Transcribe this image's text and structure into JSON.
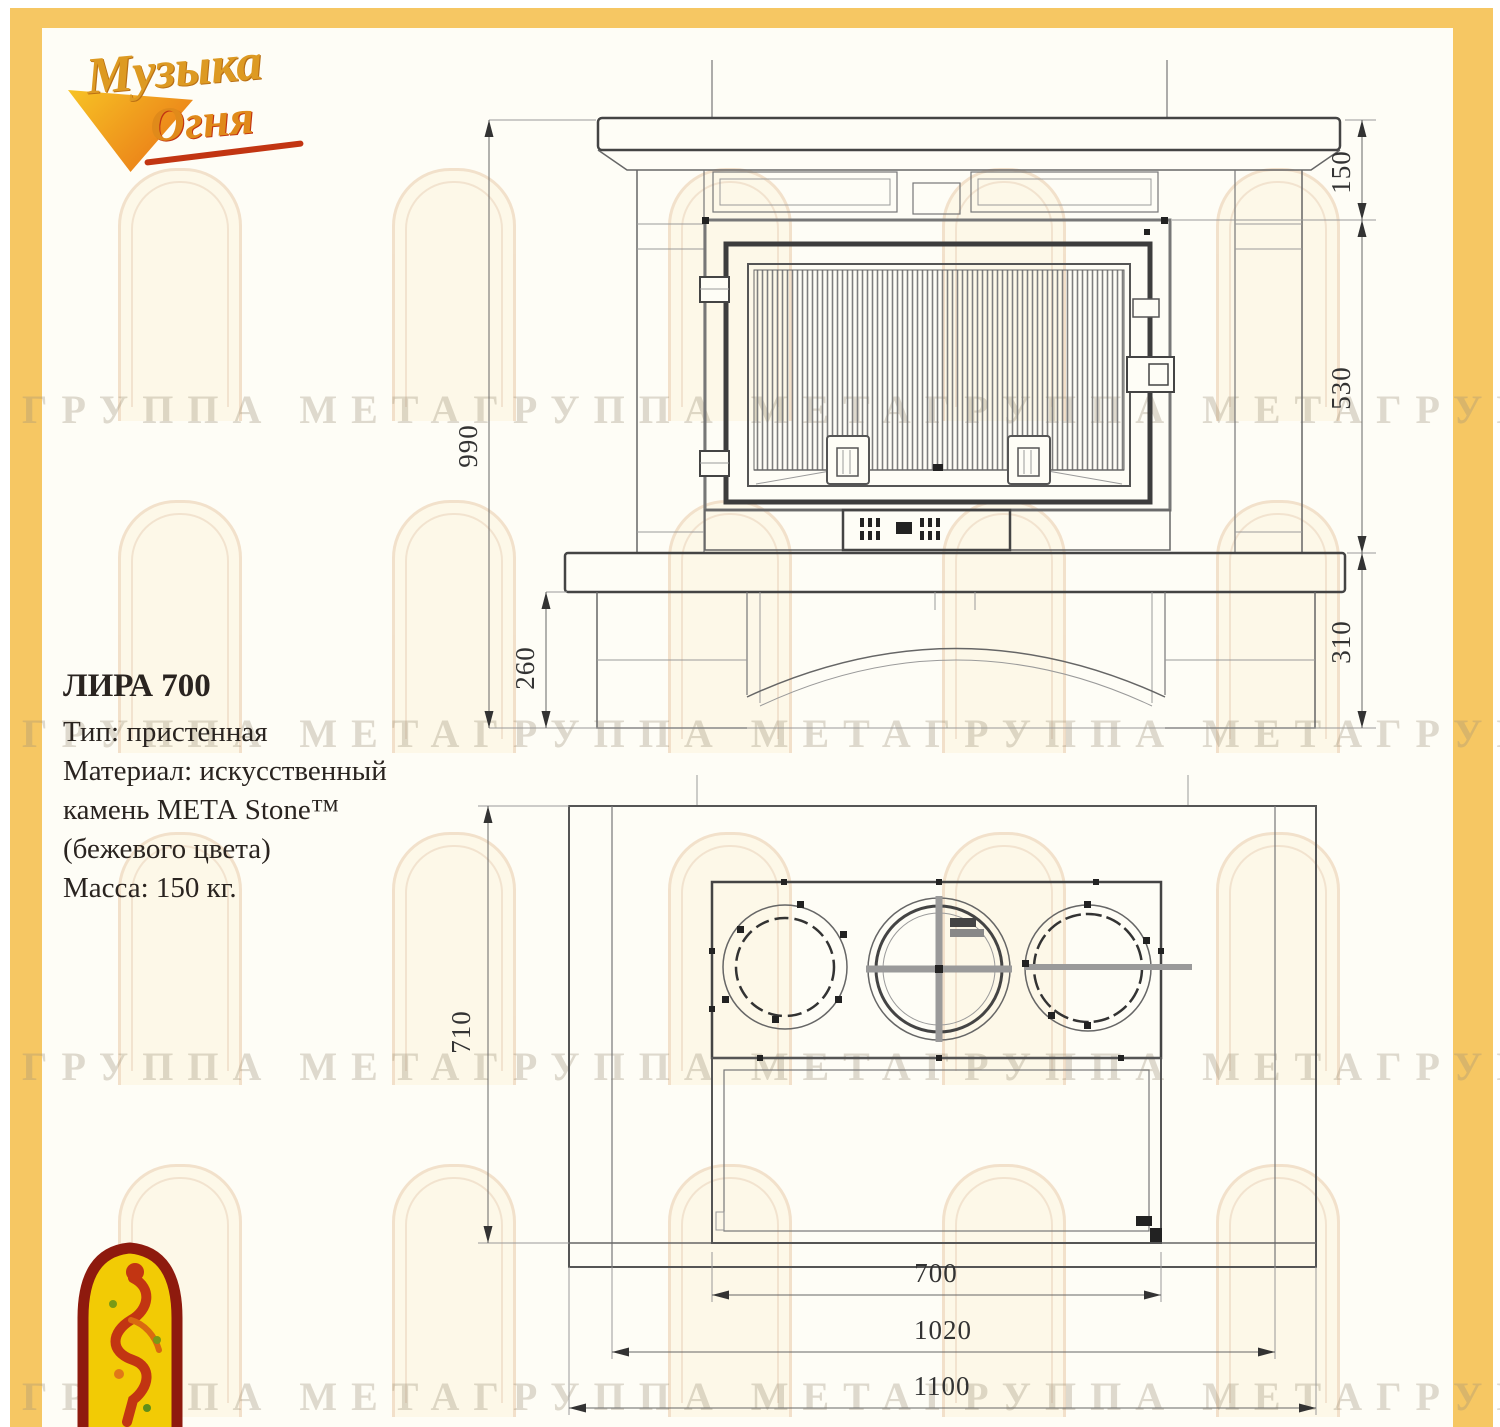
{
  "brand": {
    "line1": "Музыка",
    "line2": "Огня"
  },
  "specs": {
    "model": "ЛИРА 700",
    "lines": [
      "Тип: пристенная",
      "Материал: искусственный",
      "камень МЕТА Stone™",
      "(бежевого цвета)",
      "Масса: 150 кг."
    ]
  },
  "watermark": {
    "row": "ГРУППА МЕТАГРУППА МЕТАГРУППА МЕТАГРУППА МЕТА"
  },
  "front_view": {
    "dims": {
      "total_height": "990",
      "base_height": "260",
      "mantel_height": "150",
      "firebox_height": "530",
      "hearth_height": "310"
    }
  },
  "top_view": {
    "dims": {
      "depth": "710",
      "inner_width": "700",
      "middle_width": "1020",
      "outer_width": "1100"
    }
  },
  "colors": {
    "frame_yellow": "#F6C763",
    "line_dark": "#444444",
    "accent_red": "#C23512",
    "emblem_yellow": "#F2CB05",
    "emblem_border": "#8E1A0E"
  }
}
